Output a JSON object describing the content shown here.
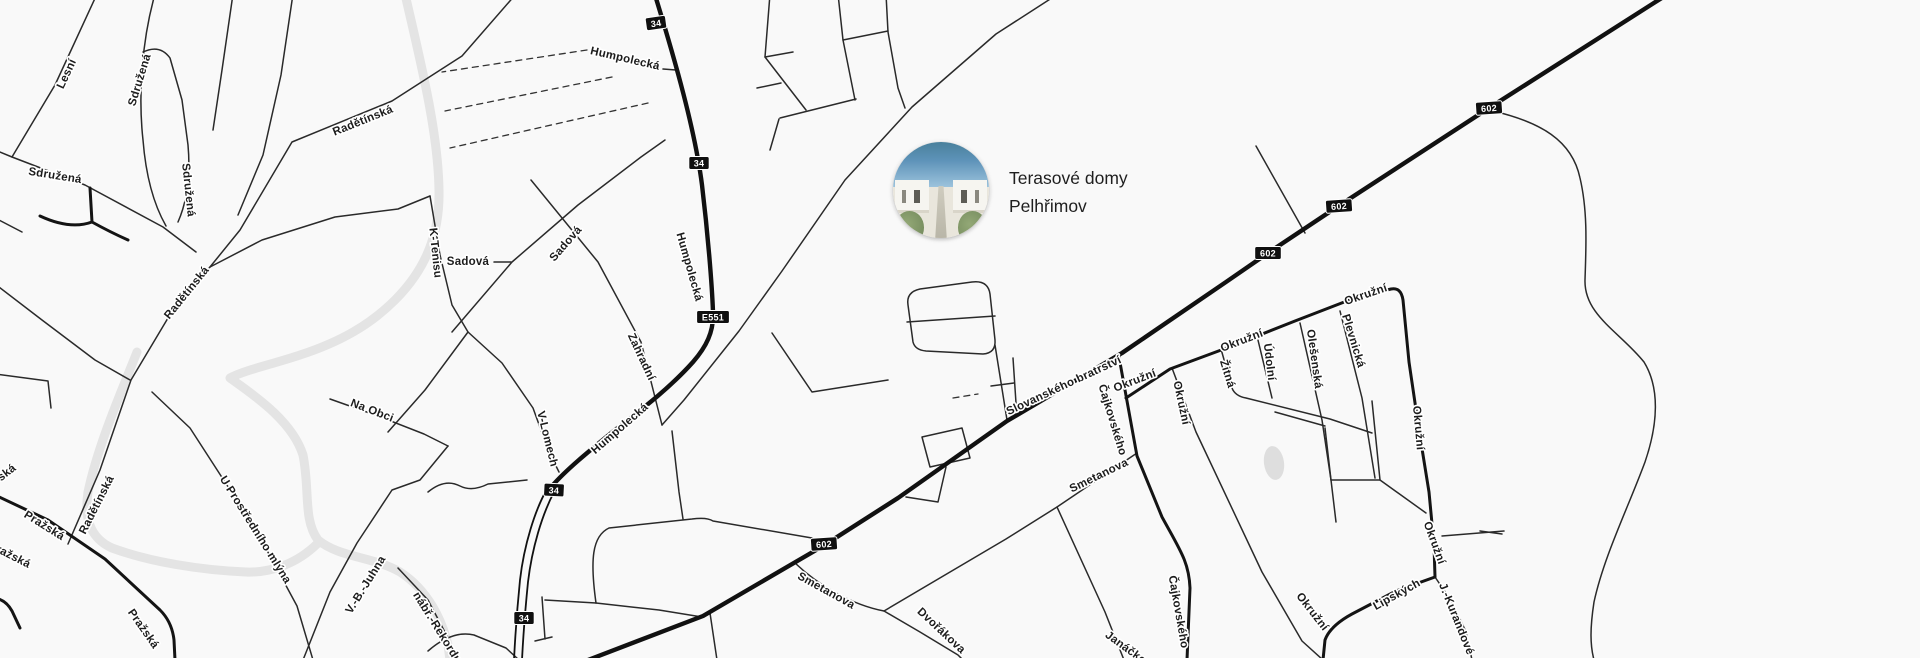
{
  "map": {
    "colors": {
      "background": "#f9f9f9",
      "road": "#141414",
      "river": "#e4e4e4",
      "label": "#1c1c1c",
      "label_halo": "#ffffff",
      "gray_label": "#9b9b9b",
      "shield_bg": "#101010",
      "shield_text": "#ffffff",
      "pond": "#dedede"
    },
    "street_labels": [
      {
        "text": "Lesní",
        "x": 67,
        "y": 74,
        "rot": -65
      },
      {
        "text": "Sdružená",
        "x": 140,
        "y": 80,
        "rot": -73
      },
      {
        "text": "Sdružená",
        "x": 55,
        "y": 176,
        "rot": 9
      },
      {
        "text": "Sdružená",
        "x": 188,
        "y": 190,
        "rot": 84
      },
      {
        "text": "Radětínská",
        "x": 363,
        "y": 121,
        "rot": -22
      },
      {
        "text": "Radětínská",
        "x": 187,
        "y": 293,
        "rot": -51
      },
      {
        "text": "Radětínská",
        "x": 97,
        "y": 505,
        "rot": -63
      },
      {
        "text": "Humpolecká",
        "x": 625,
        "y": 59,
        "rot": 13
      },
      {
        "text": "Humpolecká",
        "x": 689,
        "y": 267,
        "rot": 74
      },
      {
        "text": "Humpolecká",
        "x": 620,
        "y": 429,
        "rot": -41
      },
      {
        "text": "Sadová",
        "x": 468,
        "y": 262,
        "rot": 0
      },
      {
        "text": "Sadová",
        "x": 566,
        "y": 244,
        "rot": -49
      },
      {
        "text": "K-Tenisu",
        "x": 435,
        "y": 253,
        "rot": 84
      },
      {
        "text": "Zahradní",
        "x": 641,
        "y": 357,
        "rot": 65
      },
      {
        "text": "V-Lomech",
        "x": 547,
        "y": 439,
        "rot": 76
      },
      {
        "text": "Na Obci",
        "x": 372,
        "y": 411,
        "rot": 21
      },
      {
        "text": "U Prostředního mlýna",
        "x": 255,
        "y": 530,
        "rot": 58
      },
      {
        "text": "V.-B.-Juhna",
        "x": 366,
        "y": 585,
        "rot": -58
      },
      {
        "text": "nábř.-Rekordu",
        "x": 437,
        "y": 628,
        "rot": 58
      },
      {
        "text": "Pražská",
        "x": 44,
        "y": 526,
        "rot": 32
      },
      {
        "text": "Pražská",
        "x": 143,
        "y": 629,
        "rot": 55
      },
      {
        "text": "ražská",
        "x": 13,
        "y": 557,
        "rot": 27,
        "color": "#9b9b9b"
      },
      {
        "text": "ská",
        "x": 7,
        "y": 473,
        "rot": -38
      },
      {
        "text": "Slovanského bratrství",
        "x": 1064,
        "y": 386,
        "rot": -25
      },
      {
        "text": "Čajkovského",
        "x": 1112,
        "y": 420,
        "rot": 73
      },
      {
        "text": "Čajkovského",
        "x": 1178,
        "y": 612,
        "rot": 80
      },
      {
        "text": "Smetanova",
        "x": 1099,
        "y": 476,
        "rot": -26
      },
      {
        "text": "Smetanova",
        "x": 826,
        "y": 591,
        "rot": 29
      },
      {
        "text": "Dvořákova",
        "x": 941,
        "y": 631,
        "rot": 43
      },
      {
        "text": "Janáčkova",
        "x": 1131,
        "y": 652,
        "rot": 36
      },
      {
        "text": "Okružní",
        "x": 1135,
        "y": 381,
        "rot": -21
      },
      {
        "text": "Okružní",
        "x": 1181,
        "y": 403,
        "rot": 78
      },
      {
        "text": "Okružní",
        "x": 1242,
        "y": 341,
        "rot": -21
      },
      {
        "text": "Okružní",
        "x": 1366,
        "y": 295,
        "rot": -19
      },
      {
        "text": "Okružní",
        "x": 1418,
        "y": 428,
        "rot": 85
      },
      {
        "text": "Okružní",
        "x": 1434,
        "y": 543,
        "rot": 70
      },
      {
        "text": "Okružní",
        "x": 1312,
        "y": 612,
        "rot": 52
      },
      {
        "text": "Žitná",
        "x": 1227,
        "y": 374,
        "rot": 73
      },
      {
        "text": "Údolní",
        "x": 1269,
        "y": 362,
        "rot": 83
      },
      {
        "text": "Olešenská",
        "x": 1314,
        "y": 359,
        "rot": 82
      },
      {
        "text": "Plevnická",
        "x": 1353,
        "y": 341,
        "rot": 73
      },
      {
        "text": "Lipských",
        "x": 1397,
        "y": 595,
        "rot": -29
      },
      {
        "text": "J.-Kurandové",
        "x": 1456,
        "y": 619,
        "rot": 68
      }
    ],
    "route_shields": [
      {
        "text": "34",
        "x": 656,
        "y": 23,
        "rot": -8
      },
      {
        "text": "34",
        "x": 699,
        "y": 163,
        "rot": 0
      },
      {
        "text": "34",
        "x": 554,
        "y": 490,
        "rot": 3
      },
      {
        "text": "34",
        "x": 524,
        "y": 618,
        "rot": 0
      },
      {
        "text": "E551",
        "x": 713,
        "y": 317,
        "rot": 0
      },
      {
        "text": "602",
        "x": 1489,
        "y": 108,
        "rot": -4
      },
      {
        "text": "602",
        "x": 1339,
        "y": 206,
        "rot": -4
      },
      {
        "text": "602",
        "x": 1268,
        "y": 253,
        "rot": 0
      },
      {
        "text": "602",
        "x": 824,
        "y": 544,
        "rot": -4
      }
    ],
    "poi": {
      "title_line1": "Terasové domy",
      "title_line2": "Pelhřimov",
      "marker_cx": 941,
      "marker_cy": 190,
      "marker_radius": 48,
      "photo_sky": "#5d92b8",
      "photo_building": "#f6f5f0",
      "photo_green": "#6d8457",
      "photo_path": "#c4c1b3"
    }
  }
}
